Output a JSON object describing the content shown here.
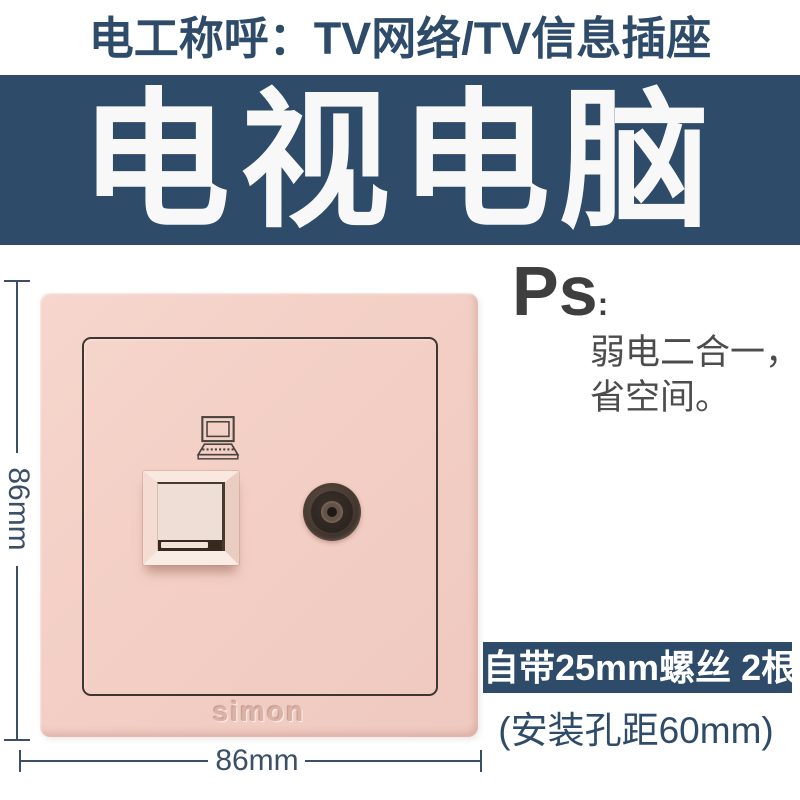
{
  "header": {
    "title": "电工称呼：TV网络/TV信息插座",
    "banner": "电视电脑"
  },
  "ps": {
    "label": "Ps",
    "colon": ":",
    "lines": [
      "弱电二合一，",
      "省空间。"
    ]
  },
  "plate": {
    "brand": "simon",
    "ports": {
      "network": "rj45-network-port",
      "tv": "tv-coax-port"
    }
  },
  "dimensions": {
    "height_label": "86mm",
    "width_label": "86mm"
  },
  "footer": {
    "screws_badge": "自带25mm螺丝 2根",
    "hole_spacing": "(安装孔距60mm)"
  },
  "colors": {
    "navy": "#2e4b69",
    "plate-pink": "#f3cfc5",
    "ink-gray": "#454545",
    "dim-line": "#3c4f66"
  }
}
